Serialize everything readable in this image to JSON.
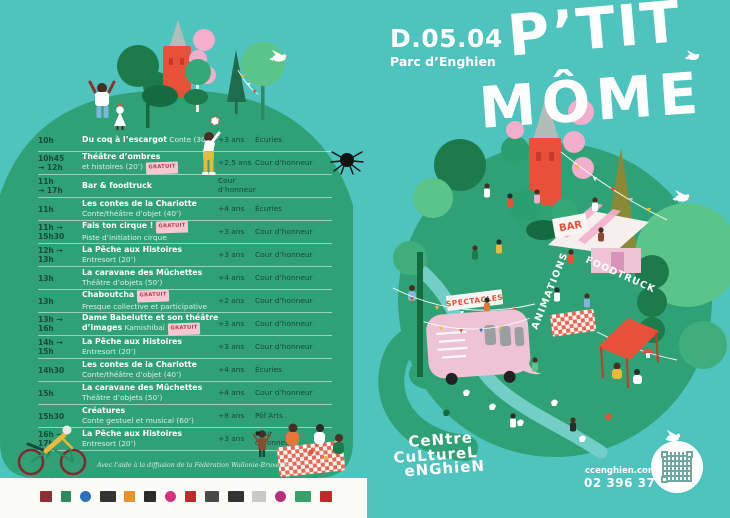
{
  "poster": {
    "date": "D.05.04",
    "venue": "Parc d’Enghien",
    "title_line1": "P’TIT",
    "title_line2": "MÔME"
  },
  "schedule": {
    "rows": [
      {
        "t1": "10h",
        "t2": "",
        "b1": "Du coq à l’escargot",
        "r1": " Conte (30’)",
        "g1": "",
        "b2": "",
        "r2": "",
        "g2": "",
        "age": "+3 ans",
        "loc": "Écuries"
      },
      {
        "t1": "10h45",
        "t2": "→ 12h",
        "b1": "Théâtre d’ombres",
        "r1": "",
        "g1": "",
        "b2": "",
        "r2": "et histoires (20’)",
        "g2": "GRATUIT",
        "age": "+2,5 ans",
        "loc": "Cour d’honneur"
      },
      {
        "t1": "11h",
        "t2": "→ 17h",
        "b1": "Bar & foodtruck",
        "r1": "",
        "g1": "",
        "b2": "",
        "r2": "",
        "g2": "",
        "age": "",
        "loc": "Cour d’honneur"
      },
      {
        "t1": "11h",
        "t2": "",
        "b1": "Les contes de la Chariotte",
        "r1": "",
        "g1": "",
        "b2": "",
        "r2": "Conte/théâtre d’objet (40’)",
        "g2": "",
        "age": "+4 ans",
        "loc": "Écuries"
      },
      {
        "t1": "11h →",
        "t2": "15h30",
        "b1": "Fais ton cirque !",
        "r1": "",
        "g1": "GRATUIT",
        "b2": "",
        "r2": "Piste d’initiation cirque",
        "g2": "",
        "age": "+3 ans",
        "loc": "Cour d’honneur"
      },
      {
        "t1": "12h →",
        "t2": "13h",
        "b1": "La Pêche aux Histoires",
        "r1": "",
        "g1": "",
        "b2": "",
        "r2": "Entresort (20’)",
        "g2": "",
        "age": "+3 ans",
        "loc": "Cour d’honneur"
      },
      {
        "t1": "13h",
        "t2": "",
        "b1": "La caravane des Mûchettes",
        "r1": "",
        "g1": "",
        "b2": "",
        "r2": "Théâtre d’objets (50’)",
        "g2": "",
        "age": "+4 ans",
        "loc": "Cour d’honneur"
      },
      {
        "t1": "13h",
        "t2": "",
        "b1": "Chaboutcha",
        "r1": "",
        "g1": "GRATUIT",
        "b2": "",
        "r2": "Fresque collective et participative",
        "g2": "",
        "age": "+2 ans",
        "loc": "Cour d’honneur"
      },
      {
        "t1": "13h →",
        "t2": "16h",
        "b1": "Dame Babelutte et son théâtre",
        "r1": "",
        "g1": "",
        "b2": "d’images",
        "r2": " Kamishibaï",
        "g2": "GRATUIT",
        "age": "+3 ans",
        "loc": "Cour d’honneur"
      },
      {
        "t1": "14h →",
        "t2": "15h",
        "b1": "La Pêche aux Histoires",
        "r1": "",
        "g1": "",
        "b2": "",
        "r2": "Entresort (20’)",
        "g2": "",
        "age": "+3 ans",
        "loc": "Cour d’honneur"
      },
      {
        "t1": "14h30",
        "t2": "",
        "b1": "Les contes de la Chariotte",
        "r1": "",
        "g1": "",
        "b2": "",
        "r2": "Conte/théâtre d’objet (40’)",
        "g2": "",
        "age": "+4 ans",
        "loc": "Écuries"
      },
      {
        "t1": "15h",
        "t2": "",
        "b1": "La caravane des Mûchettes",
        "r1": "",
        "g1": "",
        "b2": "",
        "r2": "Théâtre d’objets (50’)",
        "g2": "",
        "age": "+4 ans",
        "loc": "Cour d’honneur"
      },
      {
        "t1": "15h30",
        "t2": "",
        "b1": "Créatures",
        "r1": "",
        "g1": "",
        "b2": "",
        "r2": "Conte gestuel et musical (60’)",
        "g2": "",
        "age": "+8 ans",
        "loc": "Pôl’Arts"
      },
      {
        "t1": "16h →",
        "t2": "17h",
        "b1": "La Pêche aux Histoires",
        "r1": "",
        "g1": "",
        "b2": "",
        "r2": "Entresort (20’)",
        "g2": "",
        "age": "+3 ans",
        "loc": "Cour d’honneur"
      }
    ]
  },
  "park_map": {
    "bar_sign": "BAR",
    "foodtruck_label": "FOODTRUCK",
    "spectacles_sign": "SPECTACLES",
    "animations_label": "ANIMATIONS"
  },
  "footer": {
    "credit": "Avec l’aide à la diffusion de la Fédération Wallonie-Bruxelles."
  },
  "contact": {
    "logo_line1": "CeNtre",
    "logo_line2": "CuLtureL",
    "logo_line3": "eNGhieN",
    "website": "ccenghien.com",
    "phone": "02 396 37 87"
  },
  "colors": {
    "background": "#4FC3BD",
    "hill_green": "#30A176",
    "dark_green_text": "#17493B",
    "accent_red": "#E8503A",
    "pink": "#F2AECB",
    "badge_bg": "#F6C9D2",
    "badge_text": "#B8394C"
  }
}
